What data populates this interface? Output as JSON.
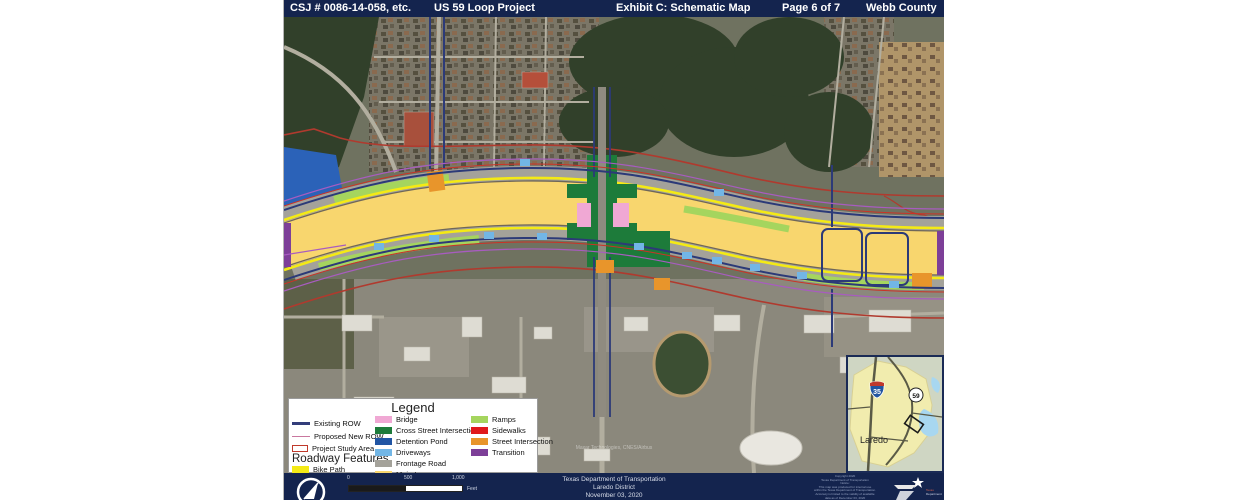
{
  "header": {
    "csj": "CSJ # 0086-14-058, etc.",
    "project": "US 59 Loop Project",
    "exhibit": "Exhibit C: Schematic Map",
    "page": "Page 6 of 7",
    "county": "Webb County"
  },
  "legend": {
    "title": "Legend",
    "line_items": [
      {
        "label": "Existing ROW",
        "color": "#333d7a"
      },
      {
        "label": "Proposed New ROW",
        "color": "#c9779f"
      },
      {
        "label": "Project Study Area",
        "color": "#c0392b"
      }
    ],
    "roadway_features_title": "Roadway Features",
    "bike_path": {
      "label": "Bike Path",
      "color": "#f4ea15"
    },
    "swatch_items": [
      {
        "label": "Bridge",
        "color": "#f0a8d4"
      },
      {
        "label": "Cross Street Intersections",
        "color": "#1d7b3a"
      },
      {
        "label": "Detention Pond",
        "color": "#2155a4"
      },
      {
        "label": "Driveways",
        "color": "#72b6e6"
      },
      {
        "label": "Frontage Road",
        "color": "#a4a29a"
      },
      {
        "label": "Main Lane",
        "color": "#f8d66e"
      },
      {
        "label": "Ramps",
        "color": "#a5d55e"
      },
      {
        "label": "Sidewalks",
        "color": "#e0191c"
      },
      {
        "label": "Street Intersection",
        "color": "#e8952b"
      },
      {
        "label": "Transition",
        "color": "#7d3f98"
      }
    ]
  },
  "map": {
    "attribution": "Maxar Technologies, CNES/Airbus"
  },
  "inset": {
    "city_label": "Laredo",
    "interstate_shield": "35",
    "us_shield": "59"
  },
  "footer": {
    "scale_ticks": [
      "0",
      "500",
      "1,000"
    ],
    "scale_unit": "Feet",
    "agency": "Texas Department of Transportation",
    "district": "Laredo District",
    "date": "November 03, 2020",
    "copyright": [
      "Copyright 2020",
      "Texas Department of Transportation",
      "Notice:",
      "This map was produced for internal use",
      "within the Texas Department of Transportation.",
      "Accuracy is limited to the validity of available",
      "data as of December 03, 2020"
    ],
    "logo_text_1": "Texas",
    "logo_text_2": "Department of Transportation"
  }
}
